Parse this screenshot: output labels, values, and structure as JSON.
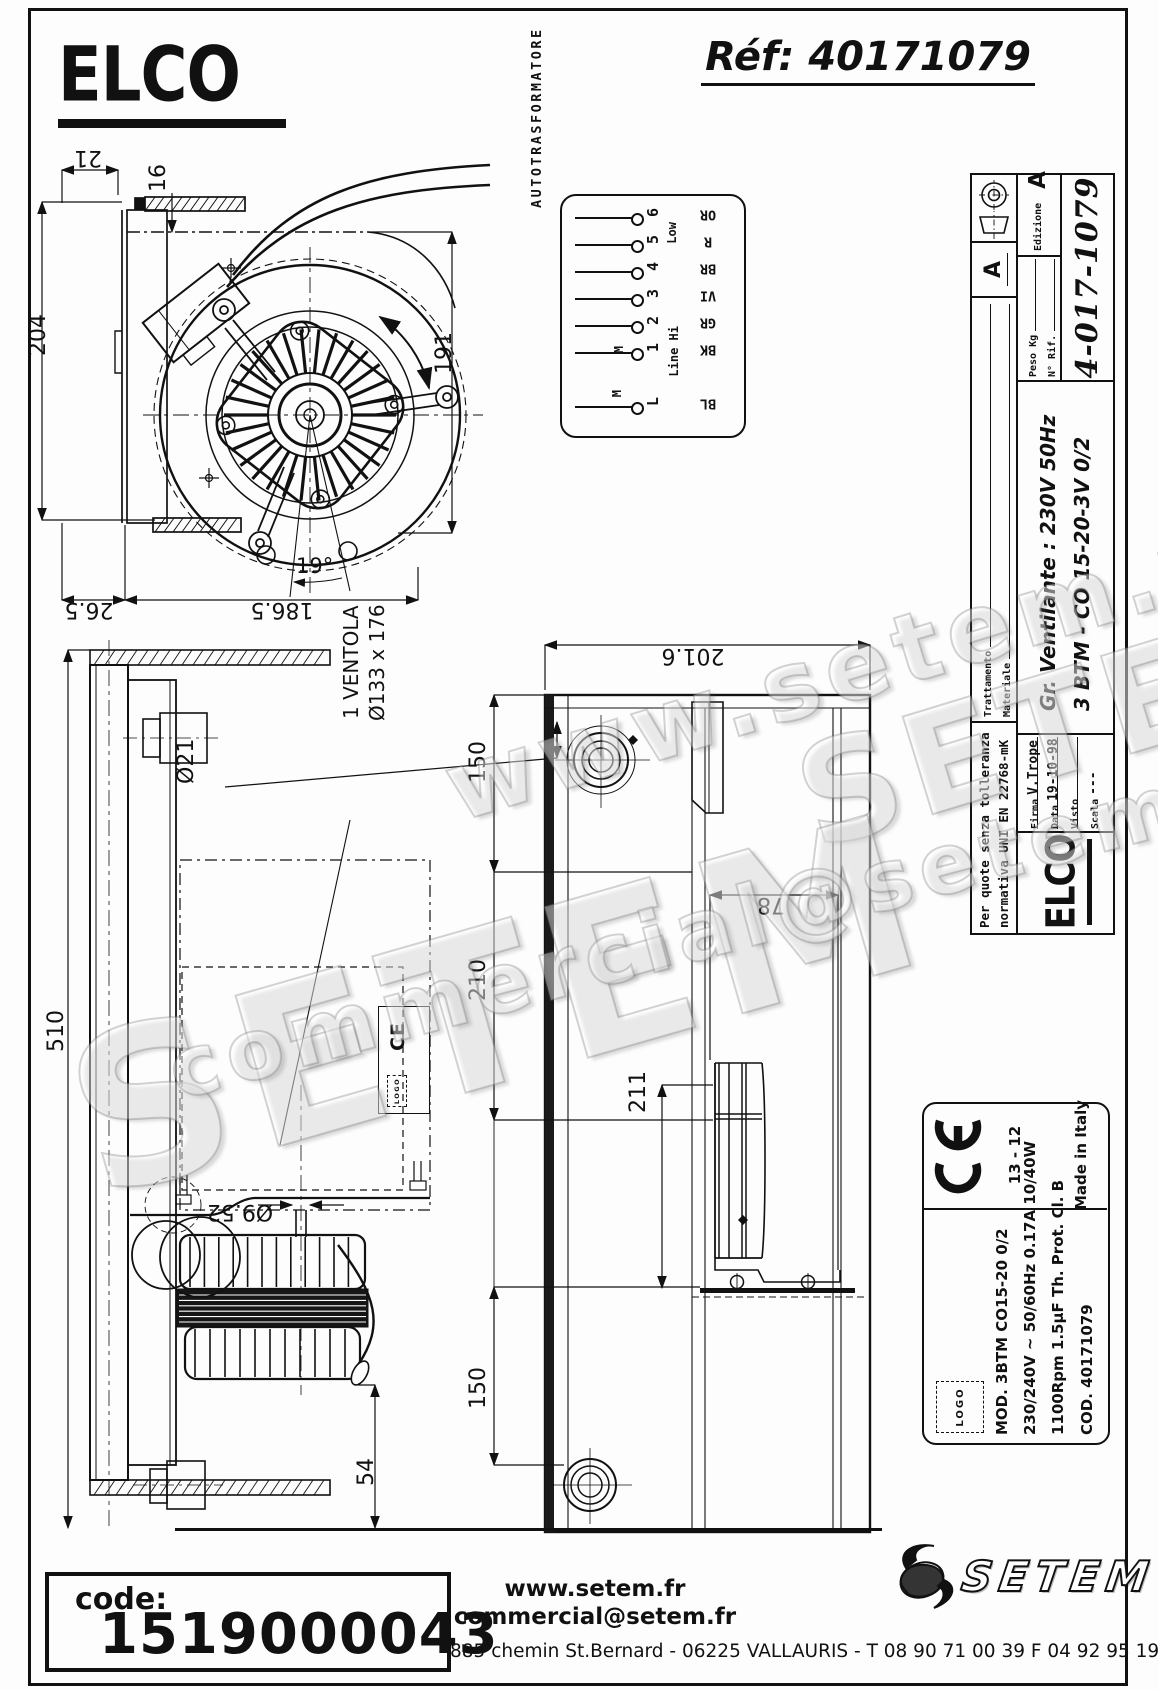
{
  "header": {
    "brand": "ELCO",
    "ref": "Réf: 40171079"
  },
  "watermarks": {
    "w1": "www.setem.fr",
    "w2": "SETEM",
    "w3": "commercial@setem.fr",
    "w4": "SETEM"
  },
  "icons": {
    "ce_mark": "CE",
    "projection_symbol": "first-angle-projection",
    "swoosh": "setem-swoosh"
  },
  "fan_view": {
    "d204": "204",
    "d21": "21",
    "d16": "16",
    "d191": "191",
    "d186": "186.5",
    "d26": "26.5",
    "d19": "19°"
  },
  "autotransformer": {
    "title": "AUTOTRASFORMATORE",
    "low": "Low",
    "hi": "Line Hi",
    "m1": "M",
    "m2": "M",
    "rows": [
      {
        "n": "6",
        "c": "OR"
      },
      {
        "n": "5",
        "c": "R"
      },
      {
        "n": "4",
        "c": "BR"
      },
      {
        "n": "3",
        "c": "VI"
      },
      {
        "n": "2",
        "c": "GR"
      },
      {
        "n": "1",
        "c": "BK"
      },
      {
        "n": "L",
        "c": "BL"
      }
    ]
  },
  "side_view": {
    "d510": "510",
    "o21": "Ø21",
    "vent1": "1 VENTOLA",
    "vent2": "Ø133 x 176",
    "o952": "Ø9.52",
    "d54": "54",
    "mini_ce": "CE",
    "mini_logo": "LOGO"
  },
  "top_view": {
    "d2016": "201.6",
    "d150a": "150",
    "d210": "210",
    "d150b": "150",
    "d78": "78",
    "d211": "211"
  },
  "title_block": {
    "tolerance1": "Per quote senza tolleranza",
    "tolerance2": "normativa UNI EN 22768-mK",
    "trattamento": "Trattamento",
    "materiale": "Materiale",
    "firma_label": "Firma",
    "firma": "V.Trope",
    "data_label": "Data",
    "data": "19-10-98",
    "visto_label": "Visto",
    "visto": "",
    "scala_label": "Scala",
    "scala": "---",
    "gr_line": "Gr. Ventilante :  230V  50Hz",
    "model_line": "3 BTM - CO 15-20-3V 0/2",
    "peso": "Peso Kg",
    "rif": "N° Rif.",
    "edizione": "Edizione",
    "edizione_val": "A",
    "marker": "A",
    "number": "4-017-1079",
    "logo": "ELCO"
  },
  "product_label": {
    "date_code": "13 - 12",
    "made_in": "Made in Italy",
    "logo_box": "LOGO",
    "mod": "MOD.  3BTM CO15-20 0/2",
    "electrical": "230/240V ~  50/60Hz   0.17A   10/40W",
    "motor": "1100Rpm   1.5µF   Th. Prot.   Cl. B",
    "cod": "COD.  40171079"
  },
  "footer": {
    "code_label": "code:",
    "code_value": "1519000043",
    "website": "www.setem.fr",
    "email": "commercial@setem.fr",
    "address": "885 chemin St.Bernard  -  06225 VALLAURIS  -  T 08 90 71 00 39   F 04 92 95 19 39",
    "brand": "SETEM"
  }
}
